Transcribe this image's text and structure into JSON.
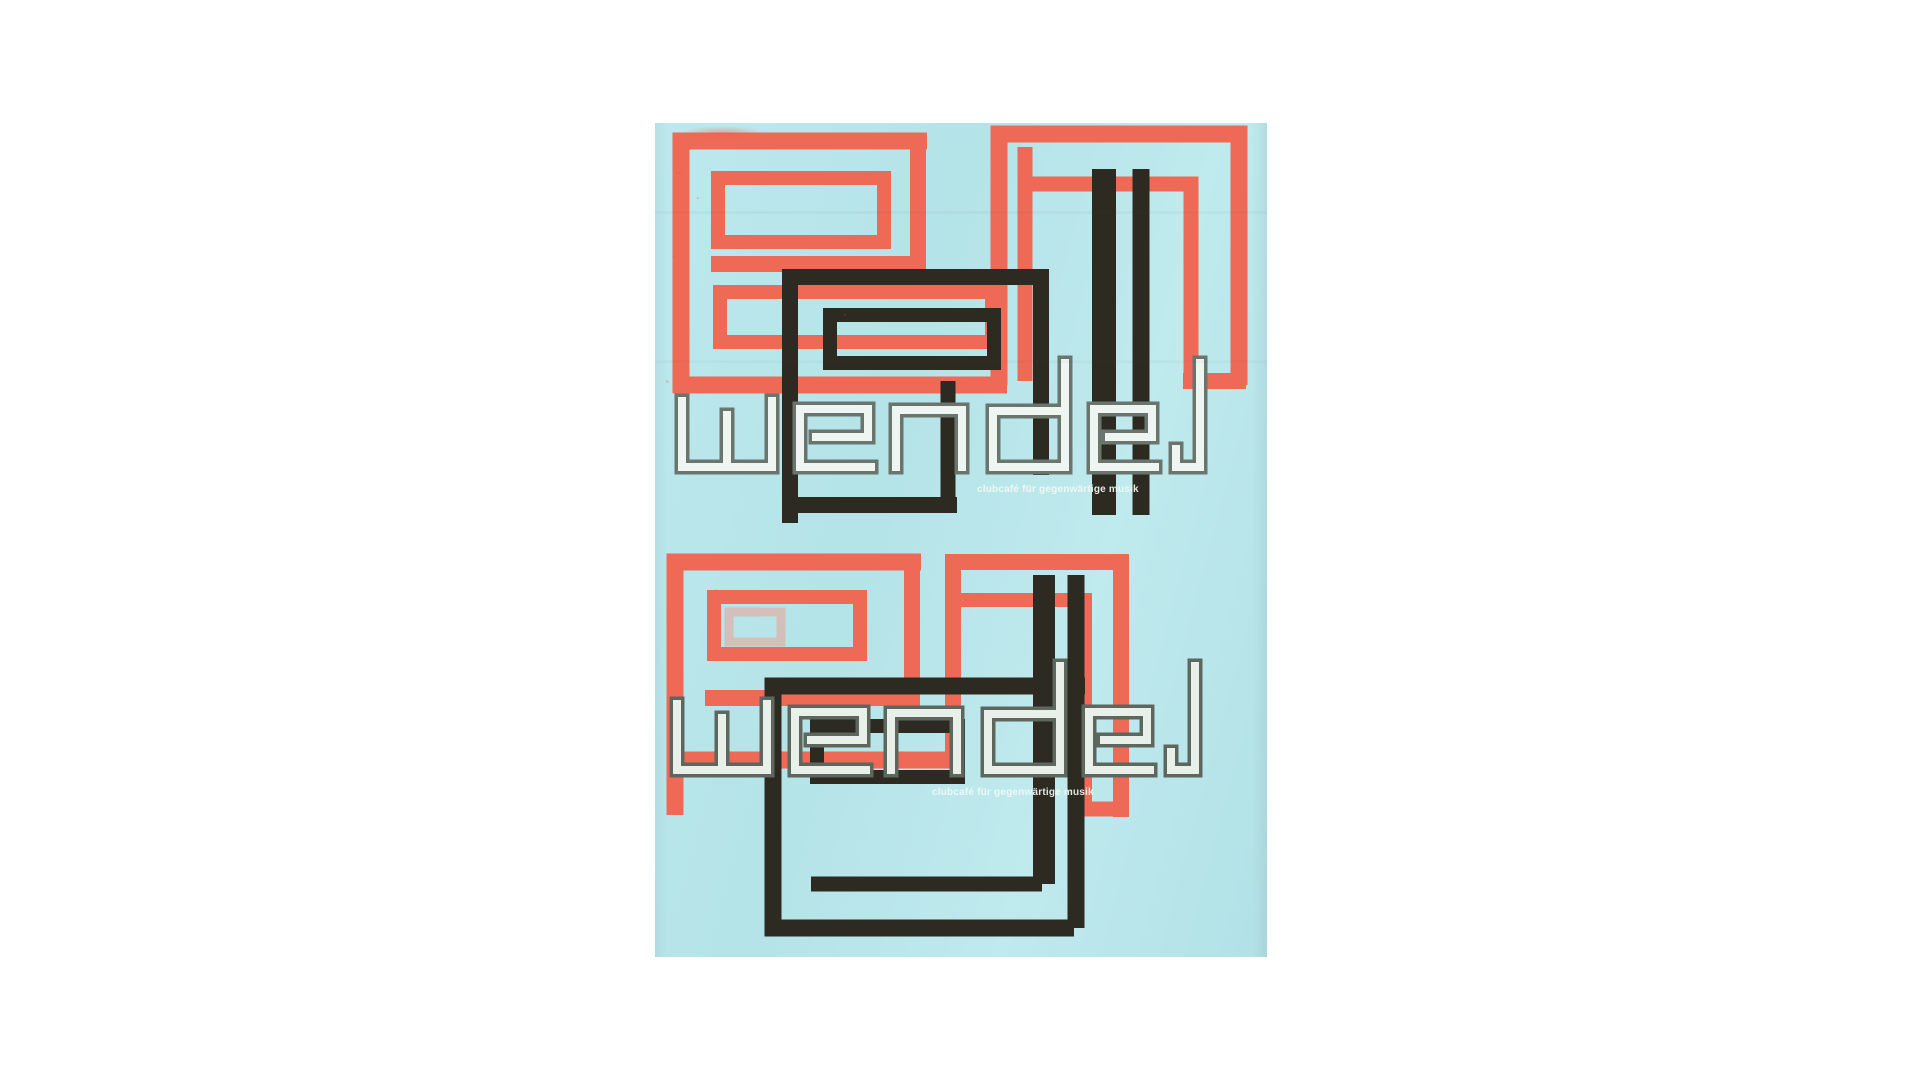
{
  "poster": {
    "title_word": "wendel",
    "taglines": [
      "clubcafé für gegenwärtige musik",
      "clubcafé für gegenwärtige musik"
    ],
    "compositions": [
      "top",
      "bottom"
    ],
    "colors": {
      "paper": "#ffffff",
      "poster_background": "#b8e6ea",
      "print_red": "#ee6a56",
      "print_black": "#2d2a21",
      "wordmark_fill": "#eff5f1",
      "wordmark_outline": "#6a756d",
      "tagline": "#f2f8f4"
    }
  }
}
